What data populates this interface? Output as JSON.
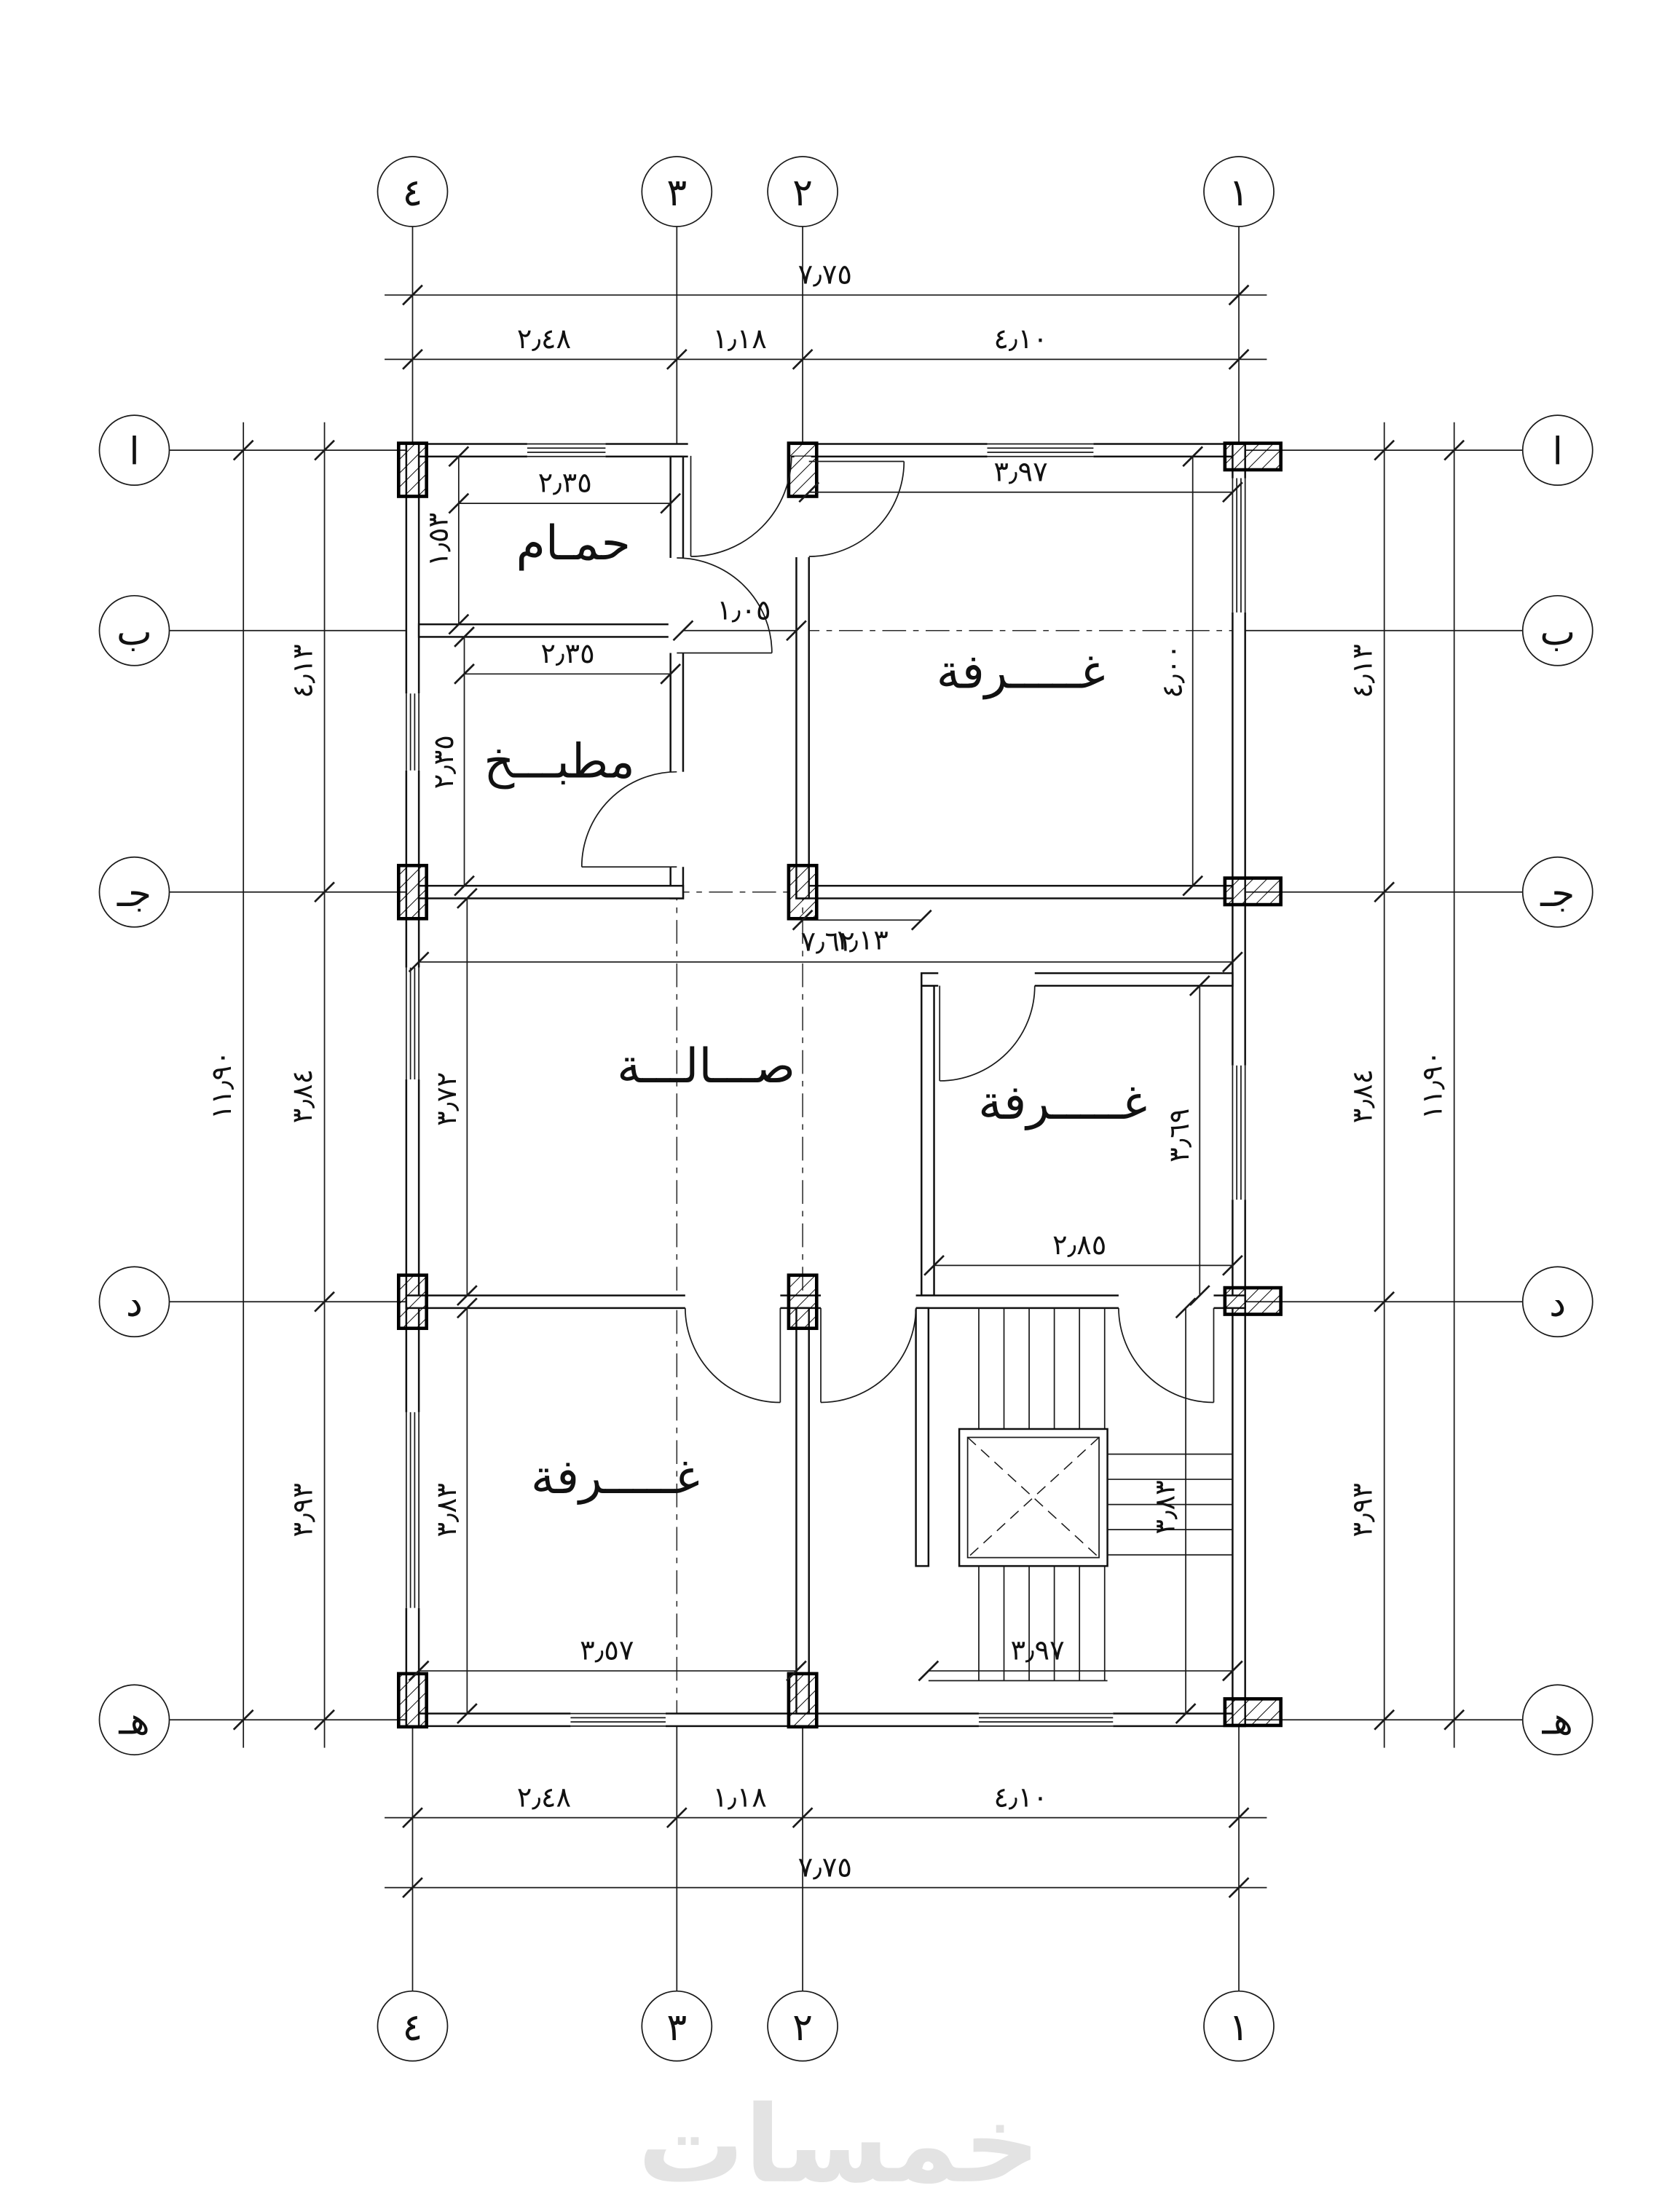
{
  "plan": {
    "grid": {
      "cols": [
        "٤",
        "٣",
        "٢",
        "١"
      ],
      "rows": [
        "ا",
        "ب",
        "جـ",
        "د",
        "هـ"
      ]
    },
    "dims": {
      "width_total": "٧٫٧٥",
      "width_segs": [
        "٢٫٤٨",
        "١٫١٨",
        "٤٫١٠"
      ],
      "height_total": "١١٫٩٠",
      "height_segs": [
        "٤٫١٣",
        "٣٫٨٤",
        "٣٫٩٣"
      ],
      "bathroom_w": "٢٫٣٥",
      "bathroom_h": "١٫٥٣",
      "kitchen_w": "٢٫٣٥",
      "kitchen_h": "٢٫٣٥",
      "corridor_w": "١٫٠٥",
      "bedroom1_w": "٣٫٩٧",
      "bedroom1_h": "٤٫٠٠",
      "hall_w": "٧٫٦٢",
      "hall_h": "٣٫٧٢",
      "hall_offset": "١٫١٣",
      "bedroom2_w": "٢٫٨٥",
      "bedroom2_h": "٣٫٦٩",
      "bedroom3_w": "٣٫٥٧",
      "bedroom3_h": "٣٫٨٣",
      "stairs_w": "٣٫٩٧",
      "stairs_h": "٣٫٨٣"
    },
    "rooms": {
      "bathroom": "حمـام",
      "kitchen": "مطبـــخ",
      "bedroom1": "غـــــرفة",
      "hall": "صـــالـــة",
      "bedroom2": "غـــــرفة",
      "bedroom3": "غـــــرفة"
    },
    "watermark": {
      "text": "خمسات",
      "color": "#e3e3e3"
    }
  }
}
